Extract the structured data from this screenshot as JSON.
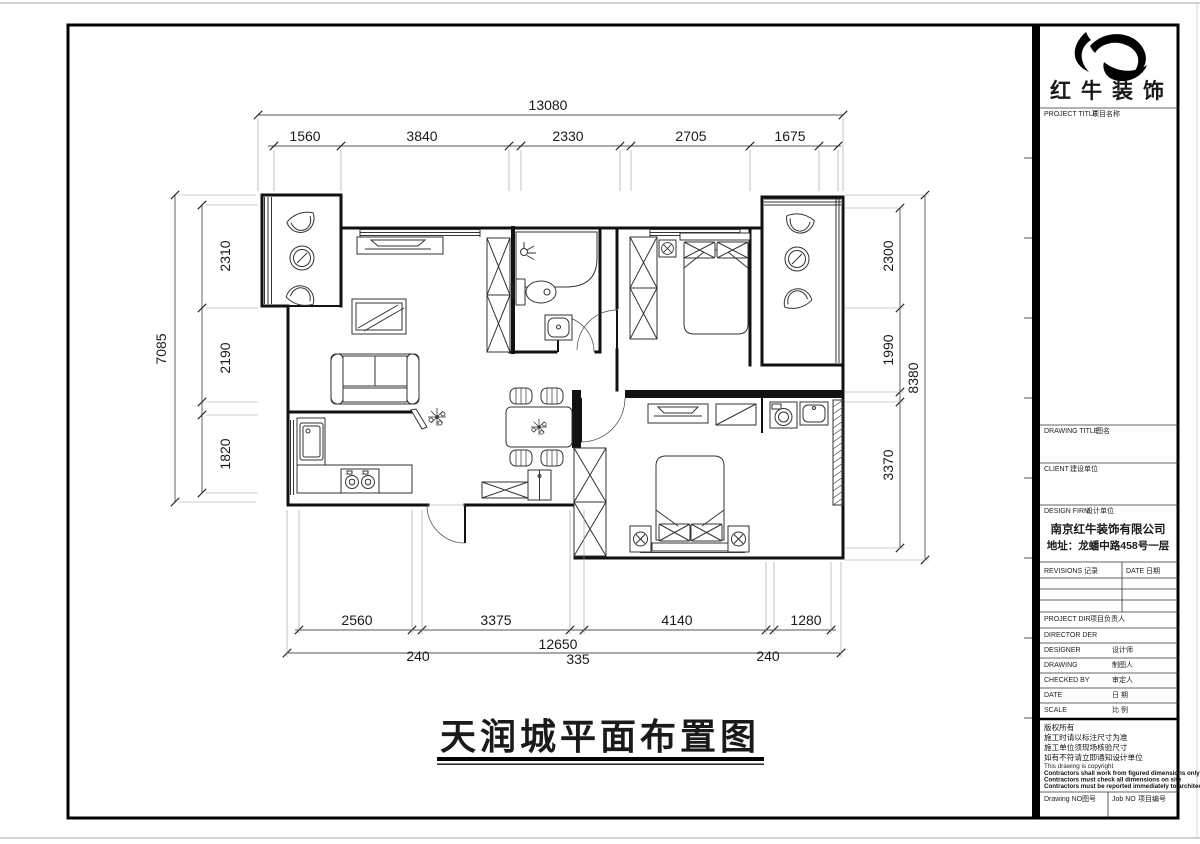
{
  "title": {
    "text": "天润城平面布置图"
  },
  "plan": {
    "washer_label": "洗衣机"
  },
  "dimensions": {
    "top": {
      "overall": "13080",
      "segments": [
        "1560",
        "3840",
        "2330",
        "2705",
        "1675"
      ]
    },
    "left": {
      "overall": "7085",
      "segments": [
        "2310",
        "2190",
        "1820"
      ]
    },
    "right": {
      "overall": "8380",
      "segments": [
        "2300",
        "1990",
        "3370"
      ]
    },
    "bottom": {
      "overall": "12650",
      "segments": [
        "2560",
        "3375",
        "4140",
        "1280"
      ],
      "gaps": [
        "240",
        "335",
        "240"
      ]
    }
  },
  "title_block": {
    "brand": "红牛装饰",
    "project_title_en": "PROJECT TITLE",
    "project_title_cn": "项目名称",
    "drawing_title_en": "DRAWING TITLE",
    "drawing_title_cn": "图名",
    "client_en": "CLIENT",
    "client_cn": "建设单位",
    "design_firm_en": "DESIGN FIRM",
    "design_firm_cn": "设计单位",
    "company": "南京红牛装饰有限公司",
    "address": "地址：龙蟠中路458号一层",
    "revisions_en": "REVISIONS",
    "revisions_cn": "记录",
    "date_col_en": "DATE",
    "date_col_cn": "日期",
    "project_dir_en": "PROJECT DIR",
    "project_dir_cn": "项目负责人",
    "director_en": "DIRECTOR DER",
    "designer_en": "DESIGNER",
    "designer_cn": "设计师",
    "drawing_en": "DRAWING",
    "drawing_cn": "制图人",
    "checked_en": "CHECKED BY",
    "checked_cn": "审定人",
    "date_en": "DATE",
    "date_cn": "日 期",
    "scale_en": "SCALE",
    "scale_cn": "比 例",
    "notes_cn": [
      "版权所有",
      "施工时请以标注尺寸为准",
      "施工单位须现场核验尺寸",
      "如有不符请立即通知设计单位"
    ],
    "notes_en": [
      "This drawing is copyright",
      "Contractors shall work from figured dimensions only",
      "Contractors must check all dimensions on site",
      "Contractors must be reported immediately to architects"
    ],
    "drawing_no_en": "Drawing NO",
    "drawing_no_cn": "图号",
    "job_no_en": "Job NO",
    "job_no_cn": "项目编号"
  }
}
